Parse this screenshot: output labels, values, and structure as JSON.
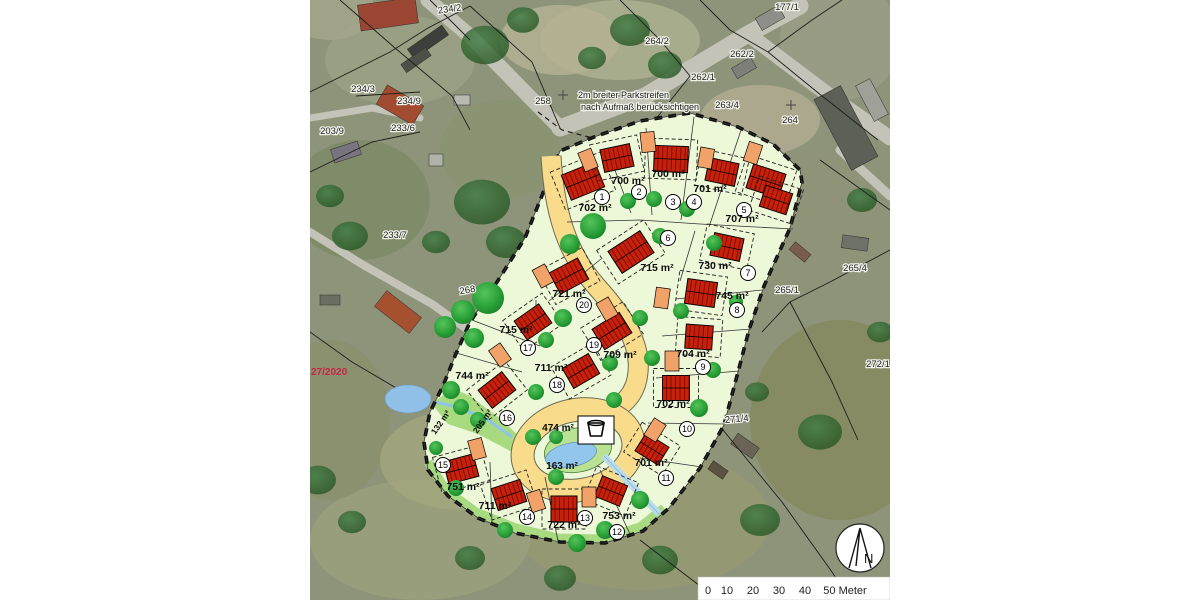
{
  "map": {
    "annotation": {
      "line1": "2m breiter Parkstreifen",
      "line2": "nach Aufmaß berücksichtigen",
      "x": 578,
      "y": 98
    },
    "watermark": {
      "text": "27/2020",
      "x": 311,
      "y": 375,
      "color": "#c52747"
    },
    "north_label": "N",
    "scalebar": {
      "y": 594,
      "labels": [
        {
          "t": "0",
          "x": 708
        },
        {
          "t": "10",
          "x": 727
        },
        {
          "t": "20",
          "x": 753
        },
        {
          "t": "30",
          "x": 779
        },
        {
          "t": "40",
          "x": 805
        },
        {
          "t": "50 Meter",
          "x": 845
        }
      ]
    },
    "colors": {
      "plan_bg": "#edf8d8",
      "road": "#f8dc8c",
      "house": "#c8200b",
      "house_dark": "#7e1206",
      "garage": "#f0a269",
      "pond": "#93c6ec",
      "meadow": "#a8da7f",
      "accent_red": "#c52747"
    },
    "lots": [
      {
        "no": "1",
        "area": "702 m²",
        "bx": 602,
        "by": 197,
        "ax": 595,
        "ay": 211
      },
      {
        "no": "2",
        "area": "700 m²",
        "bx": 639,
        "by": 192,
        "ax": 628,
        "ay": 184
      },
      {
        "no": "3",
        "area": "700 m²",
        "bx": 673,
        "by": 202,
        "ax": 668,
        "ay": 177
      },
      {
        "no": "4",
        "area": "701 m²",
        "bx": 694,
        "by": 202,
        "ax": 710,
        "ay": 192
      },
      {
        "no": "5",
        "area": "707 m²",
        "bx": 744,
        "by": 210,
        "ax": 742,
        "ay": 222
      },
      {
        "no": "6",
        "area": "715 m²",
        "bx": 668,
        "by": 238,
        "ax": 657,
        "ay": 271
      },
      {
        "no": "7",
        "area": "730 m²",
        "bx": 748,
        "by": 273,
        "ax": 715,
        "ay": 269
      },
      {
        "no": "8",
        "area": "745 m²",
        "bx": 737,
        "by": 310,
        "ax": 732,
        "ay": 299
      },
      {
        "no": "9",
        "area": "704 m²",
        "bx": 703,
        "by": 367,
        "ax": 693,
        "ay": 357
      },
      {
        "no": "10",
        "area": "702 m²",
        "bx": 687,
        "by": 429,
        "ax": 673,
        "ay": 407
      },
      {
        "no": "11",
        "area": "701 m²",
        "bx": 666,
        "by": 478,
        "ax": 651,
        "ay": 466
      },
      {
        "no": "12",
        "area": "753 m²",
        "bx": 617,
        "by": 532,
        "ax": 619,
        "ay": 519
      },
      {
        "no": "13",
        "area": "722 m²",
        "bx": 585,
        "by": 518,
        "ax": 564,
        "ay": 528
      },
      {
        "no": "14",
        "area": "711 m²",
        "bx": 527,
        "by": 517,
        "ax": 495,
        "ay": 509
      },
      {
        "no": "15",
        "area": "751 m²",
        "bx": 443,
        "by": 465,
        "ax": 463,
        "ay": 490
      },
      {
        "no": "16",
        "area": "744 m²",
        "bx": 507,
        "by": 418,
        "ax": 472,
        "ay": 379
      },
      {
        "no": "17",
        "area": "715 m²",
        "bx": 528,
        "by": 348,
        "ax": 516,
        "ay": 333
      },
      {
        "no": "18",
        "area": "711 m²",
        "bx": 557,
        "by": 385,
        "ax": 551,
        "ay": 371
      },
      {
        "no": "19",
        "area": "709 m²",
        "bx": 594,
        "by": 345,
        "ax": 620,
        "ay": 358
      },
      {
        "no": "20",
        "area": "721 m²",
        "bx": 584,
        "by": 305,
        "ax": 569,
        "ay": 297
      }
    ],
    "extra_areas": [
      {
        "text": "474 m²",
        "x": 558,
        "y": 431,
        "rot": 0
      },
      {
        "text": "163 m²",
        "x": 562,
        "y": 469,
        "rot": 0
      },
      {
        "text": "205 m²",
        "x": 485,
        "y": 423,
        "rot": -55
      },
      {
        "text": "132 m²",
        "x": 443,
        "y": 424,
        "rot": -55
      }
    ],
    "parcels": [
      {
        "text": "234/2",
        "x": 450,
        "y": 12,
        "rot": -8
      },
      {
        "text": "177/1",
        "x": 787,
        "y": 10,
        "rot": 0
      },
      {
        "text": "264/2",
        "x": 657,
        "y": 44,
        "rot": 0
      },
      {
        "text": "262/2",
        "x": 742,
        "y": 57,
        "rot": 0
      },
      {
        "text": "262/1",
        "x": 703,
        "y": 80,
        "rot": 0
      },
      {
        "text": "263/4",
        "x": 727,
        "y": 108,
        "rot": 0
      },
      {
        "text": "264",
        "x": 790,
        "y": 123,
        "rot": 0
      },
      {
        "text": "258",
        "x": 543,
        "y": 104,
        "rot": 0
      },
      {
        "text": "234/3",
        "x": 363,
        "y": 92,
        "rot": 0
      },
      {
        "text": "234/9",
        "x": 409,
        "y": 104,
        "rot": 0
      },
      {
        "text": "233/6",
        "x": 403,
        "y": 131,
        "rot": 0
      },
      {
        "text": "203/9",
        "x": 332,
        "y": 134,
        "rot": 0
      },
      {
        "text": "233/7",
        "x": 395,
        "y": 238,
        "rot": 0
      },
      {
        "text": "268",
        "x": 468,
        "y": 293,
        "rot": -10
      },
      {
        "text": "265/4",
        "x": 855,
        "y": 271,
        "rot": 0
      },
      {
        "text": "265/1",
        "x": 787,
        "y": 293,
        "rot": 0
      },
      {
        "text": "272/1",
        "x": 878,
        "y": 367,
        "rot": 0
      },
      {
        "text": "271/4",
        "x": 737,
        "y": 422,
        "rot": -5
      }
    ]
  }
}
